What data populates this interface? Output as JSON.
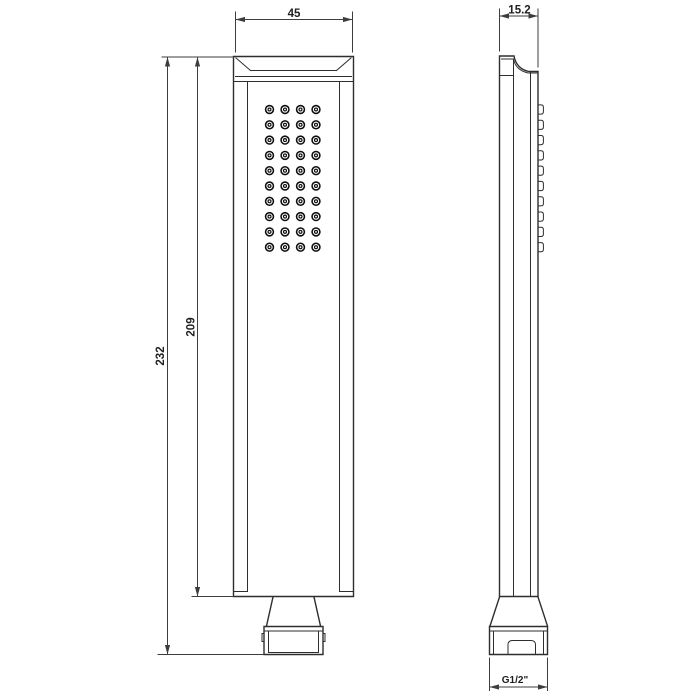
{
  "drawing": {
    "dimensions": {
      "width_mm": "45",
      "depth_mm": "15.2",
      "total_height_mm": "232",
      "body_height_mm": "209",
      "thread_size": "G1/2\""
    },
    "nozzles": {
      "rows": 10,
      "columns": 4
    },
    "colors": {
      "line": "#2e2e2e",
      "dimension": "#3d3d3d",
      "text": "#1f1f1f",
      "nozzle": "#0e0e0e",
      "background": "#ffffff"
    }
  }
}
